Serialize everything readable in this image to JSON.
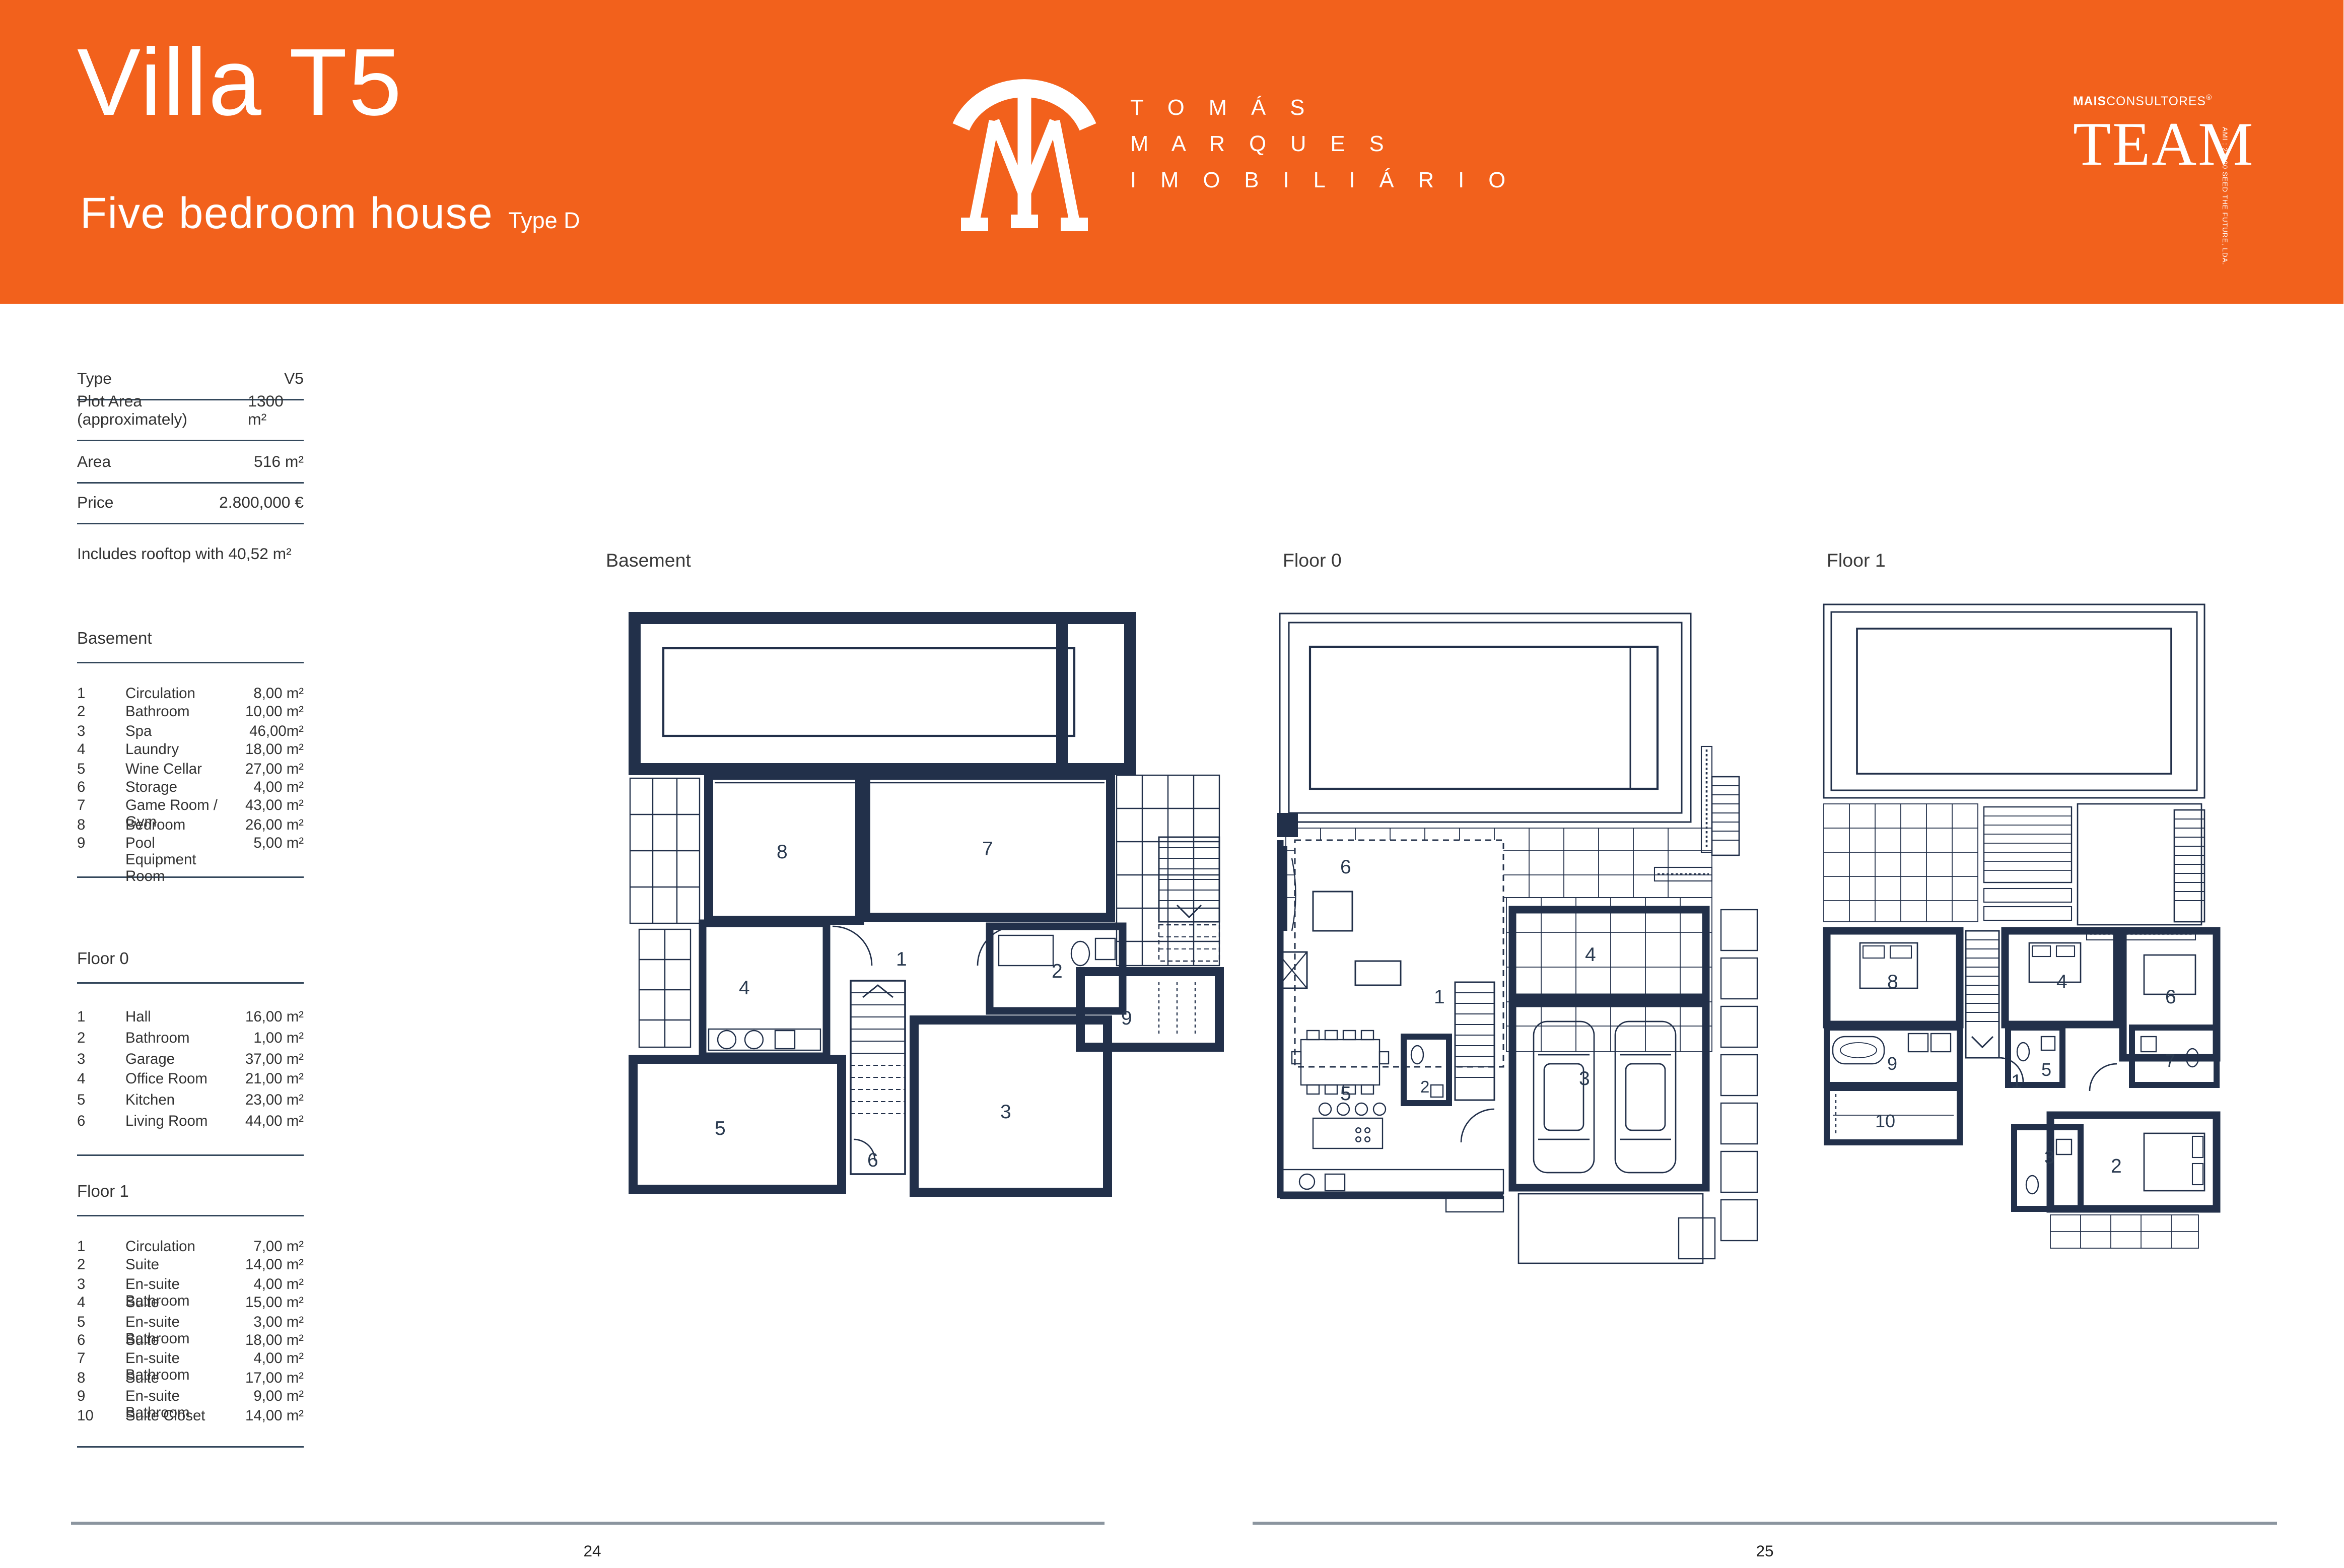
{
  "header": {
    "title": "Villa T5",
    "subtitle": "Five bedroom house",
    "type_tag": "Type D",
    "brand_lines": [
      "T O M Á S",
      "M A R Q U E S",
      "I M O B I L I Á R I O"
    ],
    "consultores_bold": "MAIS",
    "consultores_rest": "CONSULTORES",
    "consultores_reg": "®",
    "team": "TEAM",
    "team_side": "AMI : 23990   SEED THE FUTURE, LDA.",
    "bg_color": "#F2611C"
  },
  "details": {
    "rows": [
      {
        "label": "Type",
        "value": "V5"
      },
      {
        "label": "Plot Area (approximately)",
        "value": "1300 m²"
      },
      {
        "label": "Area",
        "value": "516 m²"
      },
      {
        "label": "Price",
        "value": "2.800,000 €"
      }
    ],
    "note": "Includes rooftop with 40,52 m²"
  },
  "sections": [
    {
      "title": "Basement",
      "rooms": [
        {
          "num": "1",
          "name": "Circulation",
          "area": "8,00 m²"
        },
        {
          "num": "2",
          "name": "Bathroom",
          "area": "10,00 m²"
        },
        {
          "num": "3",
          "name": "Spa",
          "area": "46,00m²"
        },
        {
          "num": "4",
          "name": "Laundry",
          "area": "18,00 m²"
        },
        {
          "num": "5",
          "name": "Wine Cellar",
          "area": "27,00 m²"
        },
        {
          "num": "6",
          "name": "Storage",
          "area": "4,00 m²"
        },
        {
          "num": "7",
          "name": "Game Room / Gym",
          "area": "43,00 m²"
        },
        {
          "num": "8",
          "name": "Bedroom",
          "area": "26,00 m²"
        },
        {
          "num": "9",
          "name": "Pool Equipment Room",
          "area": "5,00 m²"
        }
      ]
    },
    {
      "title": "Floor 0",
      "rooms": [
        {
          "num": "1",
          "name": "Hall",
          "area": "16,00 m²"
        },
        {
          "num": "2",
          "name": "Bathroom",
          "area": "1,00 m²"
        },
        {
          "num": "3",
          "name": "Garage",
          "area": "37,00 m²"
        },
        {
          "num": "4",
          "name": "Office Room",
          "area": "21,00 m²"
        },
        {
          "num": "5",
          "name": "Kitchen",
          "area": "23,00 m²"
        },
        {
          "num": "6",
          "name": "Living Room",
          "area": "44,00 m²"
        }
      ]
    },
    {
      "title": "Floor 1",
      "rooms": [
        {
          "num": "1",
          "name": "Circulation",
          "area": "7,00 m²"
        },
        {
          "num": "2",
          "name": "Suite",
          "area": "14,00 m²"
        },
        {
          "num": "3",
          "name": "En-suite Bathroom",
          "area": "4,00 m²"
        },
        {
          "num": "4",
          "name": "Suite",
          "area": "15,00 m²"
        },
        {
          "num": "5",
          "name": "En-suite Bathroom",
          "area": "3,00 m²"
        },
        {
          "num": "6",
          "name": "Suite",
          "area": "18,00 m²"
        },
        {
          "num": "7",
          "name": "En-suite Bathroom",
          "area": "4,00 m²"
        },
        {
          "num": "8",
          "name": "Suite",
          "area": "17,00 m²"
        },
        {
          "num": "9",
          "name": "En-suite Bathroom",
          "area": "9,00 m²"
        },
        {
          "num": "10",
          "name": "Suite Closet",
          "area": "14,00 m²"
        }
      ]
    }
  ],
  "plans": {
    "basement": {
      "label": "Basement",
      "labels": {
        "n1": "1",
        "n2": "2",
        "n3": "3",
        "n4": "4",
        "n5": "5",
        "n6": "6",
        "n7": "7",
        "n8": "8",
        "n9": "9"
      }
    },
    "floor0": {
      "label": "Floor 0",
      "labels": {
        "n1": "1",
        "n2": "2",
        "n3": "3",
        "n4": "4",
        "n5": "5",
        "n6": "6"
      }
    },
    "floor1": {
      "label": "Floor 1",
      "labels": {
        "n1": "1",
        "n2": "2",
        "n3": "3",
        "n4": "4",
        "n5": "5",
        "n6": "6",
        "n7": "7",
        "n8": "8",
        "n9": "9",
        "n10": "10"
      }
    }
  },
  "footer": {
    "left_page": "24",
    "right_page": "25"
  },
  "colors": {
    "orange": "#F2611C",
    "wall_navy": "#22304A",
    "rule_navy": "#33475B",
    "rule_gray": "#8B959F"
  }
}
